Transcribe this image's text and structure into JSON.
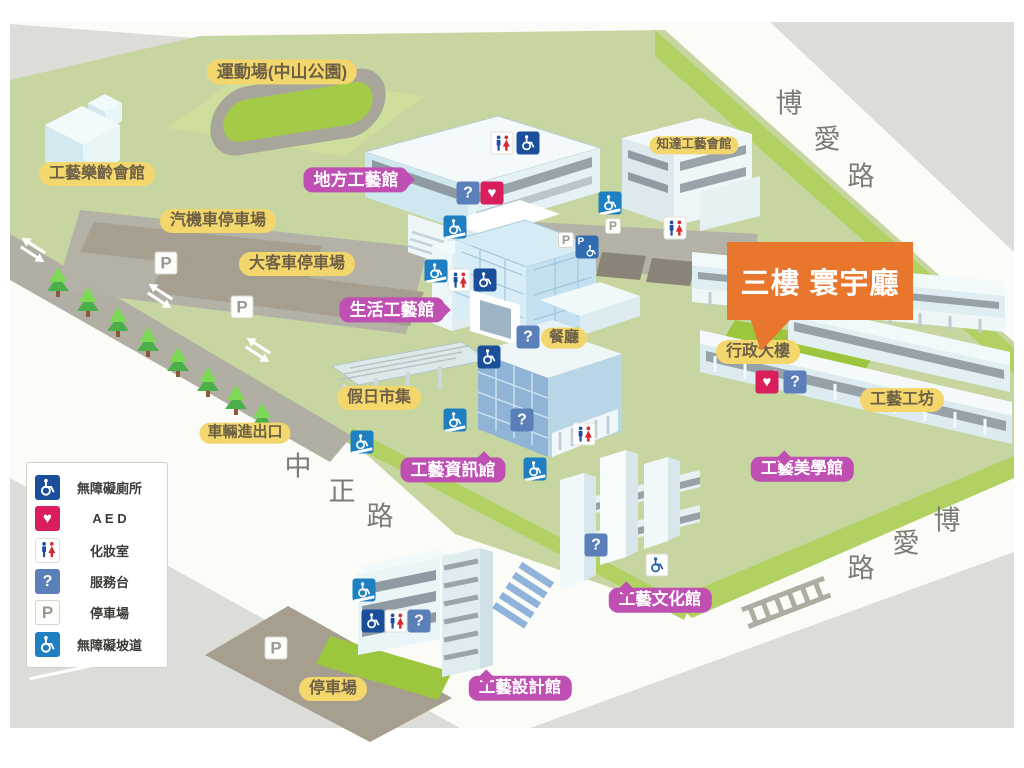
{
  "callout": {
    "text": "三樓 寰宇廳",
    "color": "#e8762c"
  },
  "roads": {
    "boai_top": {
      "name": "博愛路",
      "chars": [
        "博",
        "愛",
        "路"
      ]
    },
    "zhongzheng": {
      "name": "中正路",
      "chars": [
        "中",
        "正",
        "路"
      ]
    },
    "boai_bottom": {
      "name": "博愛路",
      "chars": [
        "博",
        "愛",
        "路"
      ]
    }
  },
  "labels": {
    "sports_field": "運動場(中山公園)",
    "senior_hall": "工藝樂齡會館",
    "car_moto_parking": "汽機車停車場",
    "bus_parking": "大客車停車場",
    "local_craft_hall": "地方工藝館",
    "zhida_hall": "知達工藝會館",
    "life_craft_hall": "生活工藝館",
    "restaurant": "餐廳",
    "holiday_market": "假日市集",
    "vehicle_gate": "車輛進出口",
    "craft_info_hall": "工藝資訊館",
    "admin_building": "行政大樓",
    "craft_workshop": "工藝工坊",
    "aesthetics_hall": "工藝美學館",
    "culture_hall": "工藝文化館",
    "design_hall": "工藝設計館",
    "south_parking": "停車場"
  },
  "legend": {
    "items": [
      {
        "icon": "accessible-toilet-icon",
        "label": "無障礙廁所"
      },
      {
        "icon": "aed-icon",
        "label": "A E D"
      },
      {
        "icon": "restroom-icon",
        "label": "化妝室"
      },
      {
        "icon": "service-desk-icon",
        "label": "服務台"
      },
      {
        "icon": "parking-icon",
        "label": "停車場"
      },
      {
        "icon": "ramp-icon",
        "label": "無障礙坡道"
      }
    ]
  },
  "icons": {
    "service_glyph": "?",
    "parking_glyph": "P",
    "aed_glyph": "♥",
    "wheelchair": "svg-shape"
  },
  "colors": {
    "label_yellow": "#f3d76d",
    "label_magenta": "#bf4fb2",
    "callout_orange": "#e8762c",
    "icon_navy": "#1b4f9c",
    "icon_ramp_blue": "#1e7fc2",
    "aed_red": "#d81e5b",
    "service_blue": "#5b7fb8",
    "campus_green": "#c7d6a1",
    "field_green": "#a3cb47"
  }
}
